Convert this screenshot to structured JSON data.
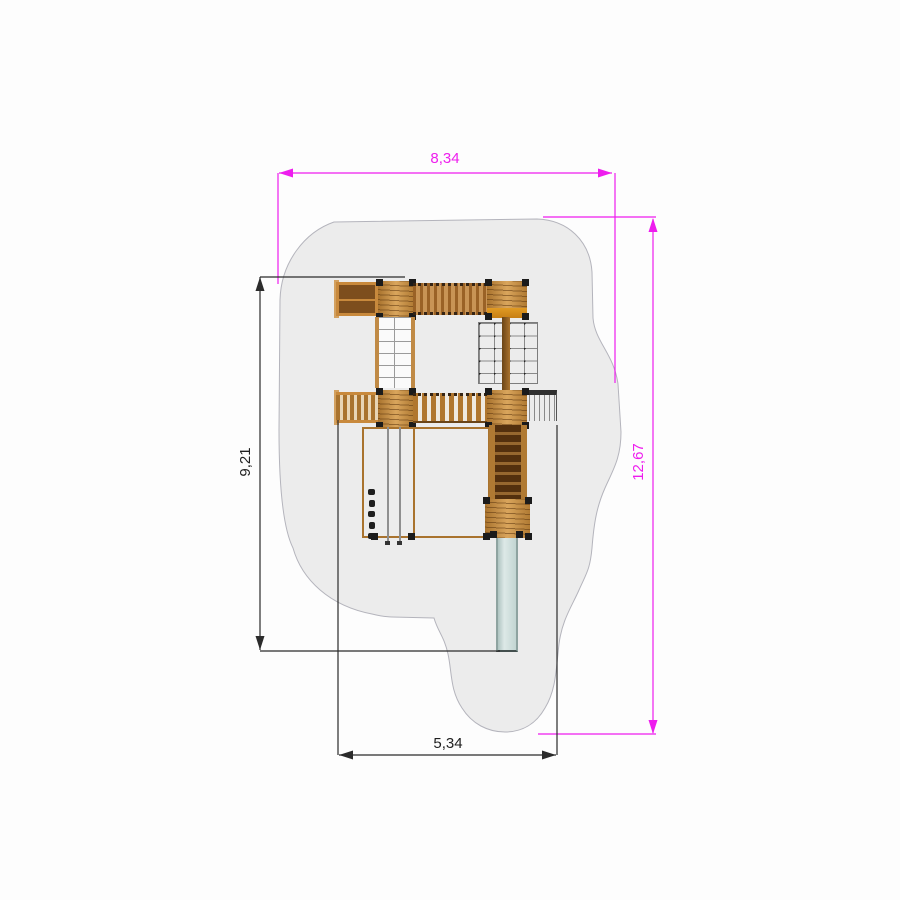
{
  "drawing": {
    "type": "playground-equipment-top-view-plan",
    "dimensions": {
      "width_total": {
        "label": "8,34",
        "color": "#ee1dee"
      },
      "height_total": {
        "label": "12,67",
        "color": "#ee1dee"
      },
      "height_equipment": {
        "label": "9,21",
        "color": "#1f1f1f"
      },
      "width_equipment": {
        "label": "5,34",
        "color": "#1f1f1f"
      }
    },
    "colors": {
      "dimension_primary": "#ee1dee",
      "dimension_secondary": "#2b2b2b",
      "safety_zone_fill": "#ececec",
      "safety_zone_stroke": "#b4b4bc",
      "wood_light": "#d9a55c",
      "wood_mid": "#b07a33",
      "wood_dark": "#53300e",
      "slide": "#cfdedb"
    },
    "components": [
      "safety-zone",
      "side-table",
      "tower-platform",
      "rung-bridge",
      "climbing-ladder",
      "climbing-net",
      "balcony-panel",
      "slat-bridge",
      "access-ladder",
      "staircase",
      "lower-platform",
      "slide",
      "ground-frame",
      "firemans-pole",
      "climbing-hold"
    ]
  }
}
